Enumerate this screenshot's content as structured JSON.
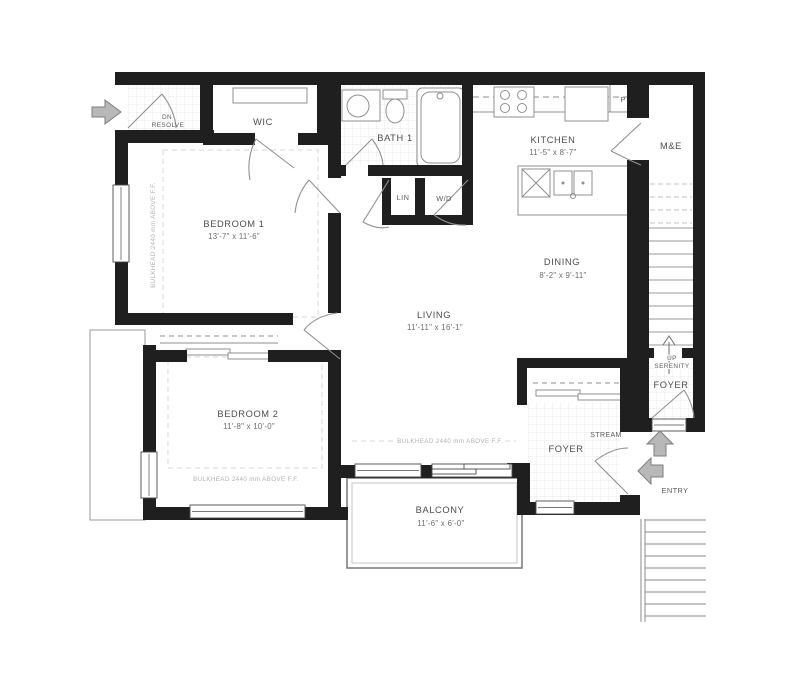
{
  "plan": {
    "rooms": {
      "bedroom1": {
        "name": "BEDROOM 1",
        "dims": "13'-7\" x 11'-6\""
      },
      "bedroom2": {
        "name": "BEDROOM 2",
        "dims": "11'-8\" x 10'-0\""
      },
      "living": {
        "name": "LIVING",
        "dims": "11'-11\" x 16'-1\""
      },
      "dining": {
        "name": "DINING",
        "dims": "8'-2\" x 9'-11\""
      },
      "kitchen": {
        "name": "KITCHEN",
        "dims": "11'-5\" x 8'-7\""
      },
      "balcony": {
        "name": "BALCONY",
        "dims": "11'-6\" x 6'-0\""
      },
      "bath1": {
        "name": "BATH 1"
      },
      "wic": {
        "name": "WIC"
      },
      "me": {
        "name": "M&E"
      },
      "foyer_inner": {
        "name": "FOYER"
      },
      "foyer_upper": {
        "name": "FOYER"
      },
      "linen": {
        "name": "LIN"
      },
      "laundry": {
        "name": "W/D"
      },
      "pantry": {
        "name": "P"
      }
    },
    "annotations": {
      "dn_line1": "DN",
      "dn_line2": "RESOLVE",
      "up": "UP",
      "up_unit": "SERENITY",
      "unit_name": "STREAM",
      "entry": "ENTRY",
      "bulkhead": "BULKHEAD 2440 mm ABOVE F.F."
    },
    "colors": {
      "wall": "#1f1f1f",
      "fixture": "#8f8f8f",
      "tile": "#e3e3e3",
      "label": "#4d4d4d",
      "dim": "#6b6b6b",
      "muted": "#b2b2b2",
      "arrow": "#b8b8b8"
    }
  }
}
